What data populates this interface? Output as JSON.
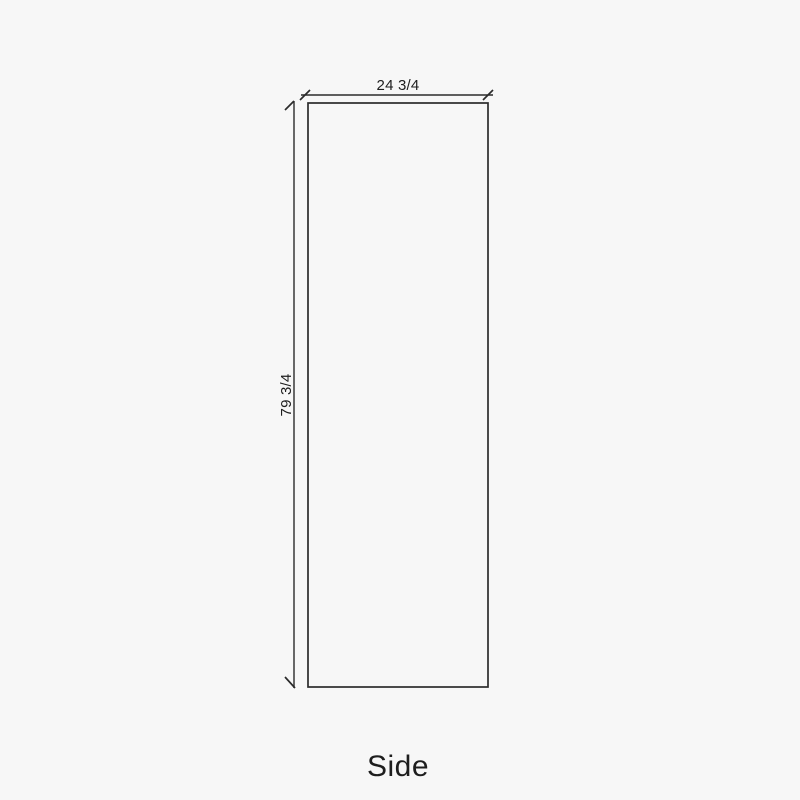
{
  "drawing": {
    "view_label": "Side",
    "width_dimension": "24 3/4",
    "height_dimension": "79 3/4"
  },
  "colors": {
    "background": "#f7f7f7",
    "line": "#2b2b2b",
    "text": "#1e1e1e"
  }
}
